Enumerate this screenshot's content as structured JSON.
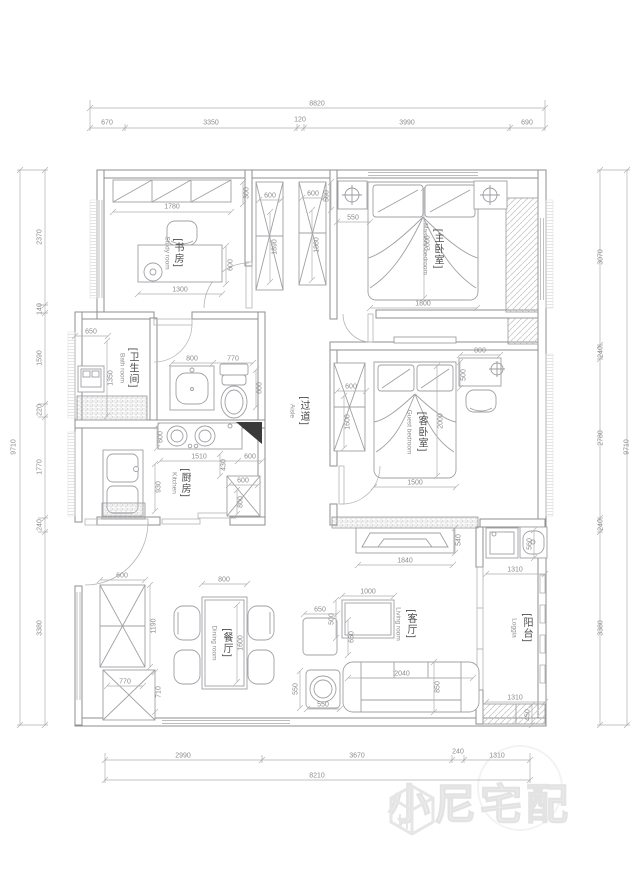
{
  "labels": {
    "study": {
      "cn": "[书房]",
      "en": "Study room"
    },
    "master": {
      "cn": "[主卧室]",
      "en": "Masters' bedroom"
    },
    "bath": {
      "cn": "[卫生间]",
      "en": "Bath room"
    },
    "guest": {
      "cn": "[客卧室]",
      "en": "Guest bedroom"
    },
    "kitchen": {
      "cn": "[厨房]",
      "en": "Kitchen"
    },
    "aisle": {
      "cn": "[过道]",
      "en": "Aisle"
    },
    "dining": {
      "cn": "[餐厅]",
      "en": "Dining room"
    },
    "living": {
      "cn": "[客厅]",
      "en": "Living room"
    },
    "balcony": {
      "cn": "[阳台]",
      "en": "Loggia"
    }
  },
  "chains": {
    "top_total": "8820",
    "top": [
      "670",
      "3350",
      "120",
      "3990",
      "690"
    ],
    "bottom_total": "8210",
    "bottom": [
      "2990",
      "3670",
      "240",
      "1310"
    ],
    "left_total": "9710",
    "left": [
      "2370",
      "140",
      "1590",
      "220",
      "1770",
      "240",
      "3380"
    ],
    "right_total": "9710",
    "right": [
      "3070",
      "240",
      "2780",
      "240",
      "3380"
    ]
  },
  "dims": {
    "study_wardrobe_w": "1780",
    "study_wardrobe_d": "300",
    "study_desk_w": "1300",
    "study_desk_d": "600",
    "closet1_w": "600",
    "closet1_h": "1890",
    "closet2_w": "600",
    "closet2_h": "1860",
    "master_nightstand_d": "500",
    "master_gap": "550",
    "master_bed_l": "2000",
    "master_bed_w": "1800",
    "bath_w": "650",
    "bath_l": "1350",
    "vanity_w": "800",
    "toilet_w": "770",
    "vanity_d": "600",
    "counter_d": "600",
    "kitchen_w": "1510",
    "kitchen_off1": "430",
    "kitchen_off2": "930",
    "kitchen_r": "600",
    "fridge_w": "600",
    "fridge_d": "800",
    "guest_wardrobe_w": "600",
    "guest_wardrobe_h": "1600",
    "guest_bed_l": "2000",
    "guest_bed_w": "1500",
    "guest_desk_w": "800",
    "guest_desk_d": "500",
    "tv_w": "1840",
    "tv_d": "540",
    "coffee_w": "1000",
    "coffee_d": "500",
    "side_w": "650",
    "side_d": "650",
    "stool_d": "550",
    "stool_w": "550",
    "sofa_w": "2040",
    "sofa_d": "850",
    "balcony_top_w": "1310",
    "balcony_sink_d": "560",
    "balcony_bot_w": "1310",
    "balcony_hatch": "450",
    "dining_cab1_w": "600",
    "dining_cab1_h": "1190",
    "dining_cab2_w": "770",
    "dining_cab2_h": "710",
    "table_w": "800",
    "table_l": "1600"
  },
  "watermark": {
    "brand": "小尼宅配"
  }
}
